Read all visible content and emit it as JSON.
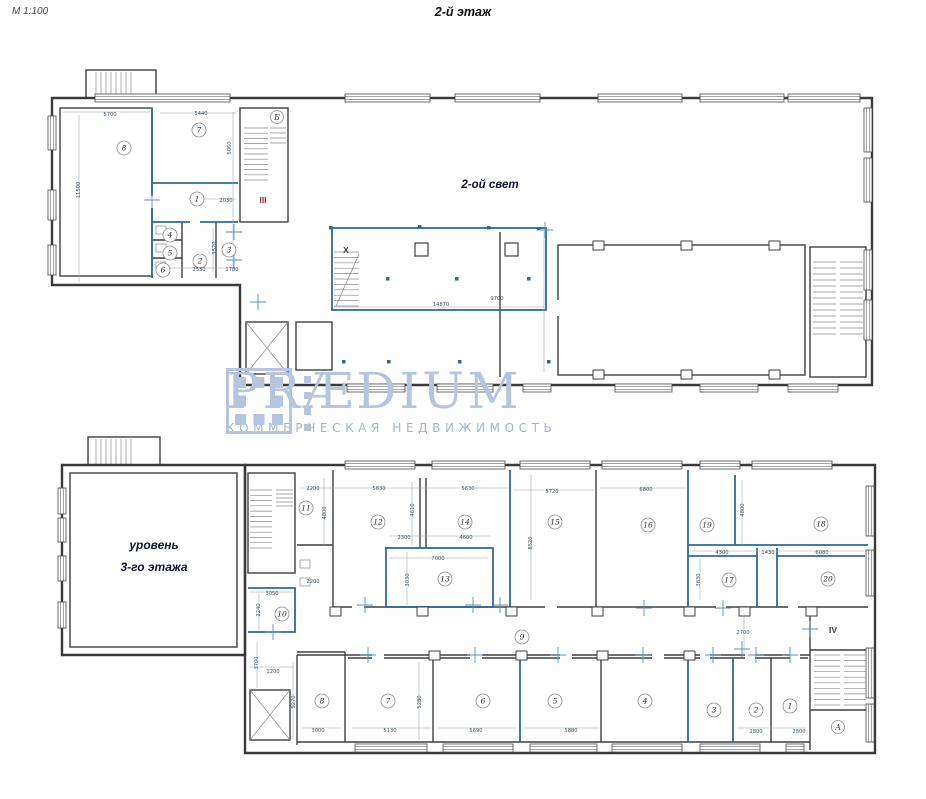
{
  "meta": {
    "scale": "М 1:100",
    "title": "2-й этаж"
  },
  "watermark": {
    "brand": "PRÆDIUM",
    "tagline": "КОММЕРЧЕСКАЯ НЕДВИЖИМОСТЬ"
  },
  "upper_plan": {
    "area_label": "2-ой свет",
    "rooms": [
      {
        "n": "8",
        "x": 124,
        "y": 148
      },
      {
        "n": "7",
        "x": 199,
        "y": 130
      },
      {
        "n": "1",
        "x": 197,
        "y": 199
      },
      {
        "n": "4",
        "x": 170,
        "y": 235
      },
      {
        "n": "5",
        "x": 170,
        "y": 253
      },
      {
        "n": "6",
        "x": 163,
        "y": 270
      },
      {
        "n": "2",
        "x": 200,
        "y": 261
      },
      {
        "n": "3",
        "x": 229,
        "y": 250
      }
    ],
    "stairs": [
      {
        "text": "Б",
        "x": 277,
        "y": 120,
        "circled": true
      },
      {
        "text": "III",
        "x": 263,
        "y": 203,
        "cls": "red"
      },
      {
        "text": "X",
        "x": 346,
        "y": 253
      }
    ],
    "dimensions": [
      {
        "t": "5700",
        "x": 110,
        "y": 116
      },
      {
        "t": "5440",
        "x": 201,
        "y": 115
      },
      {
        "t": "5060",
        "x": 231,
        "y": 148,
        "v": 1
      },
      {
        "t": "11500",
        "x": 80,
        "y": 190,
        "v": 1
      },
      {
        "t": "2030",
        "x": 226,
        "y": 202
      },
      {
        "t": "3520",
        "x": 216,
        "y": 248,
        "v": 1
      },
      {
        "t": "2530",
        "x": 199,
        "y": 271
      },
      {
        "t": "1780",
        "x": 232,
        "y": 271
      },
      {
        "t": "14870",
        "x": 441,
        "y": 306
      },
      {
        "t": "9700",
        "x": 497,
        "y": 300
      }
    ]
  },
  "lower_plan": {
    "area_label_1": "уровень",
    "area_label_2": "3-го этажа",
    "rooms": [
      {
        "n": "11",
        "x": 306,
        "y": 508
      },
      {
        "n": "12",
        "x": 378,
        "y": 522
      },
      {
        "n": "14",
        "x": 465,
        "y": 522
      },
      {
        "n": "13",
        "x": 445,
        "y": 579
      },
      {
        "n": "15",
        "x": 555,
        "y": 522
      },
      {
        "n": "16",
        "x": 648,
        "y": 525
      },
      {
        "n": "19",
        "x": 707,
        "y": 525
      },
      {
        "n": "18",
        "x": 821,
        "y": 524
      },
      {
        "n": "17",
        "x": 729,
        "y": 580
      },
      {
        "n": "20",
        "x": 828,
        "y": 579
      },
      {
        "n": "10",
        "x": 282,
        "y": 614
      },
      {
        "n": "9",
        "x": 522,
        "y": 637
      },
      {
        "n": "8",
        "x": 322,
        "y": 701
      },
      {
        "n": "7",
        "x": 388,
        "y": 701
      },
      {
        "n": "6",
        "x": 483,
        "y": 701
      },
      {
        "n": "5",
        "x": 555,
        "y": 701
      },
      {
        "n": "4",
        "x": 645,
        "y": 701
      },
      {
        "n": "3",
        "x": 714,
        "y": 710
      },
      {
        "n": "2",
        "x": 756,
        "y": 710
      },
      {
        "n": "1",
        "x": 790,
        "y": 706
      }
    ],
    "stairs": [
      {
        "text": "IV",
        "x": 833,
        "y": 633
      },
      {
        "text": "А",
        "x": 838,
        "y": 730,
        "circled": true
      }
    ],
    "dimensions": [
      {
        "t": "2200",
        "x": 313,
        "y": 490
      },
      {
        "t": "5830",
        "x": 379,
        "y": 490
      },
      {
        "t": "5630",
        "x": 468,
        "y": 490
      },
      {
        "t": "5720",
        "x": 552,
        "y": 493
      },
      {
        "t": "6800",
        "x": 646,
        "y": 491
      },
      {
        "t": "4610",
        "x": 414,
        "y": 510,
        "v": 1
      },
      {
        "t": "4800",
        "x": 326,
        "y": 513,
        "v": 1
      },
      {
        "t": "4800",
        "x": 744,
        "y": 510,
        "v": 1
      },
      {
        "t": "8520",
        "x": 532,
        "y": 543,
        "v": 1
      },
      {
        "t": "2300",
        "x": 404,
        "y": 539
      },
      {
        "t": "4600",
        "x": 466,
        "y": 539
      },
      {
        "t": "7000",
        "x": 438,
        "y": 560
      },
      {
        "t": "3030",
        "x": 409,
        "y": 580,
        "v": 1
      },
      {
        "t": "2200",
        "x": 313,
        "y": 583
      },
      {
        "t": "4300",
        "x": 722,
        "y": 554
      },
      {
        "t": "1430",
        "x": 768,
        "y": 554
      },
      {
        "t": "6080",
        "x": 822,
        "y": 554
      },
      {
        "t": "3630",
        "x": 700,
        "y": 580,
        "v": 1
      },
      {
        "t": "3050",
        "x": 272,
        "y": 595
      },
      {
        "t": "2240",
        "x": 260,
        "y": 610,
        "v": 1
      },
      {
        "t": "3700",
        "x": 258,
        "y": 663,
        "v": 1
      },
      {
        "t": "1200",
        "x": 273,
        "y": 673
      },
      {
        "t": "2700",
        "x": 743,
        "y": 634
      },
      {
        "t": "5270",
        "x": 295,
        "y": 702,
        "v": 1
      },
      {
        "t": "3000",
        "x": 318,
        "y": 732
      },
      {
        "t": "5130",
        "x": 390,
        "y": 732
      },
      {
        "t": "5280",
        "x": 421,
        "y": 702,
        "v": 1
      },
      {
        "t": "5690",
        "x": 476,
        "y": 732
      },
      {
        "t": "5880",
        "x": 571,
        "y": 732
      },
      {
        "t": "2800",
        "x": 756,
        "y": 733
      },
      {
        "t": "2800",
        "x": 799,
        "y": 733
      }
    ]
  }
}
